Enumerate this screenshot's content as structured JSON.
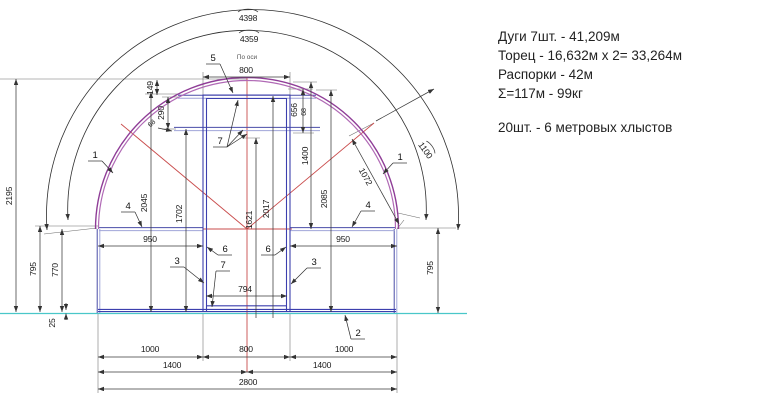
{
  "notes": {
    "line1": "Дуги 7шт. - 41,209м",
    "line2": "Торец - 16,632м х 2= 33,264м",
    "line3": "Распорки - 42м",
    "line4": "Σ=117м - 99кг",
    "line5": "20шт. - 6 метровых хлыстов"
  },
  "dims": {
    "arc_outer": "4398",
    "arc_inner": "4359",
    "axis_note": "По оси",
    "top_800": "800",
    "v149": "149",
    "v290": "290",
    "small_left": "68",
    "v656": "656",
    "small_right": "68",
    "v1400": "1400",
    "v2085": "2085",
    "v2017": "2017",
    "v1621": "1621",
    "v2045": "2045",
    "v1702": "1702",
    "diag_1072": "1072",
    "arc_1100": "1100",
    "h950_left": "950",
    "h950_right": "950",
    "h794": "794",
    "v2195": "2195",
    "v795_left": "795",
    "v770": "770",
    "v25": "25",
    "v795_right": "795",
    "b1000_left": "1000",
    "b800": "800",
    "b1000_right": "1000",
    "b1400_left": "1400",
    "b1400_right": "1400",
    "b2800": "2800"
  },
  "labels": {
    "arch_left": "1",
    "arch_right": "1",
    "base": "2",
    "jamb_left": "3",
    "jamb_right": "3",
    "strut_left": "4",
    "strut_right": "4",
    "ridge_bar": "5",
    "post_left": "6",
    "post_right": "6",
    "header": "7",
    "sill": "7"
  },
  "colors": {
    "structure_blue": "#3c3fae",
    "arch_purple": "#8f3d97",
    "axis_red": "#c94b4b",
    "ground_cyan": "#49c7c9",
    "dimension": "#3a3a3a"
  }
}
